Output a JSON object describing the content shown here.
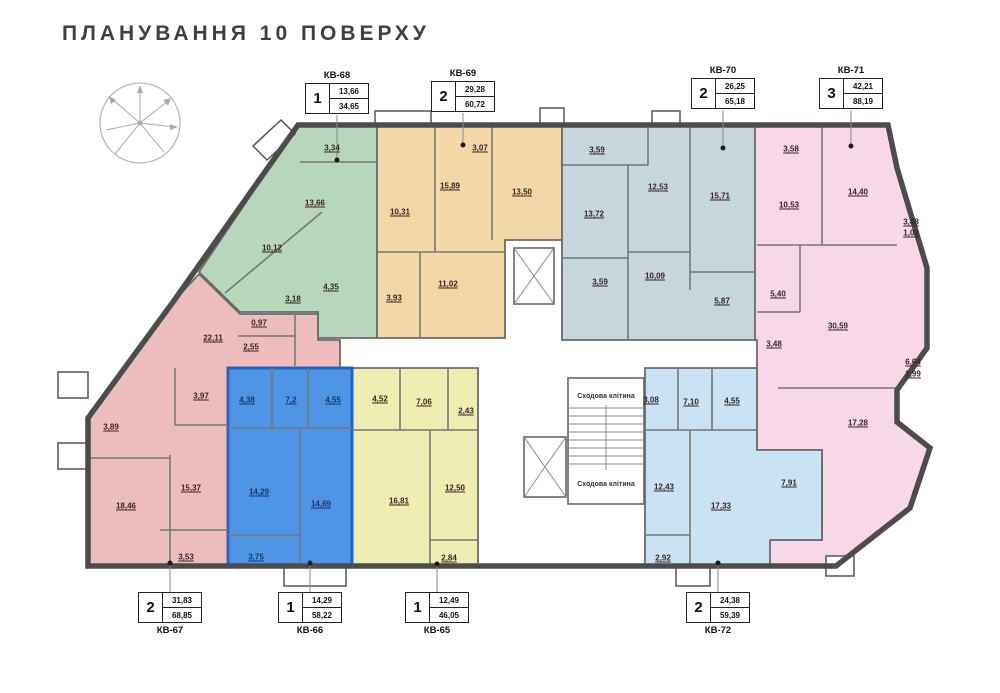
{
  "title": "ПЛАНУВАННЯ 10 ПОВЕРХУ",
  "colors": {
    "kv65": "#f0edb2",
    "kv66": "#4e95e5",
    "kv67": "#edbdbd",
    "kv68": "#b7d7ba",
    "kv69": "#f4d7a6",
    "kv70": "#c6d6dd",
    "kv71": "#f8d7e9",
    "kv72": "#c9e2f4"
  },
  "core": {
    "stairwell_top": "Сходова клітина",
    "stairwell_bottom": "Сходова клітина"
  },
  "apartments": {
    "kv68": {
      "name": "КВ-68",
      "rooms_count": "1",
      "living_area": "13,66",
      "total_area": "34,65",
      "room_areas": [
        "3,34",
        "13,66",
        "10,12",
        "3,18",
        "4,35"
      ]
    },
    "kv69": {
      "name": "КВ-69",
      "rooms_count": "2",
      "living_area": "29,28",
      "total_area": "60,72",
      "room_areas": [
        "3,07",
        "15,89",
        "10,31",
        "13,50",
        "3,93",
        "11,02"
      ]
    },
    "kv70": {
      "name": "КВ-70",
      "rooms_count": "2",
      "living_area": "26,25",
      "total_area": "65,18",
      "room_areas": [
        "3,59",
        "12,53",
        "15,71",
        "13,72",
        "3,59",
        "10,09",
        "5,87"
      ]
    },
    "kv71": {
      "name": "КВ-71",
      "rooms_count": "3",
      "living_area": "42,21",
      "total_area": "88,19",
      "room_areas": [
        "3,58",
        "10,53",
        "14,40",
        "3,48",
        "1,02",
        "5,40",
        "30,59",
        "3,48",
        "6,64",
        "1,99",
        "17,28"
      ]
    },
    "kv67": {
      "name": "КВ-67",
      "rooms_count": "2",
      "living_area": "31,83",
      "total_area": "68,85",
      "room_areas": [
        "22,11",
        "0,97",
        "2,55",
        "3,97",
        "3,89",
        "15,37",
        "18,46",
        "3,53"
      ]
    },
    "kv66": {
      "name": "КВ-66",
      "rooms_count": "1",
      "living_area": "14,29",
      "total_area": "58,22",
      "room_areas": [
        "4,38",
        "7,2",
        "4,55",
        "14,29",
        "14,69",
        "3,75"
      ]
    },
    "kv65": {
      "name": "КВ-65",
      "rooms_count": "1",
      "living_area": "12,49",
      "total_area": "46,05",
      "room_areas": [
        "4,52",
        "7,06",
        "2,43",
        "16,81",
        "12,50",
        "2,84"
      ]
    },
    "kv72": {
      "name": "КВ-72",
      "rooms_count": "2",
      "living_area": "24,38",
      "total_area": "59,39",
      "room_areas": [
        "3,08",
        "7,10",
        "4,55",
        "12,43",
        "17,33",
        "2,92",
        "7,91"
      ]
    }
  }
}
